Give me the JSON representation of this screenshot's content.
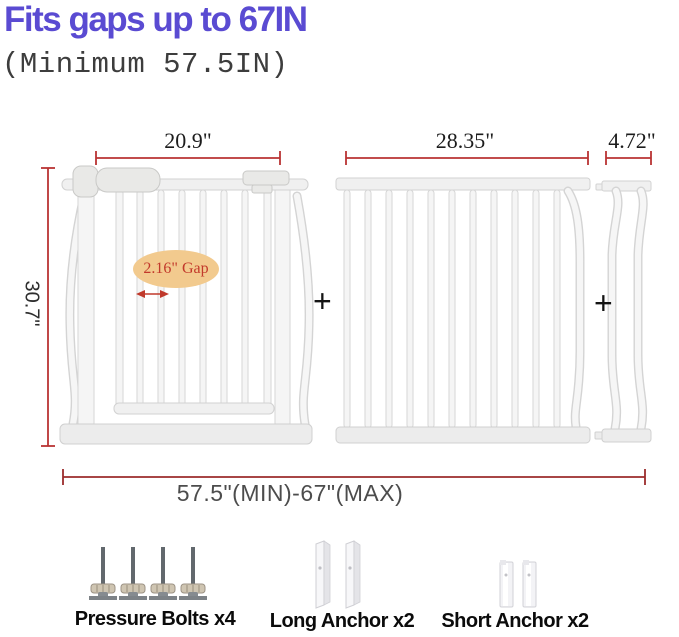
{
  "header": {
    "title": "Fits gaps up to 67IN",
    "subtitle": "(Minimum 57.5IN)"
  },
  "diagram": {
    "gate_width_label": "20.9\"",
    "extension_width_label": "28.35\"",
    "small_extension_width_label": "4.72\"",
    "height_label": "30.7\"",
    "range_label": "57.5\"(MIN)-67\"(MAX)",
    "gap_label": "2.16\" Gap",
    "plus_sign": "+"
  },
  "accessories": {
    "pressure_bolts_label": "Pressure Bolts x4",
    "long_anchor_label": "Long Anchor x2",
    "short_anchor_label": "Short Anchor x2"
  },
  "icons": {
    "pressure_bolt": "pressure-bolt-icon",
    "long_anchor": "long-anchor-icon",
    "short_anchor": "short-anchor-icon",
    "gap_arrow": "gap-arrow-icon",
    "plus": "plus-sign"
  },
  "colors": {
    "title_purple": "#5a4bd2",
    "dimension_red": "#b93333",
    "bottom_dimension_red": "#9b2c2c",
    "gap_ellipse_fill": "#f2ca8e",
    "gap_text_red": "#c2392b",
    "gate_white": "#f5f5f5",
    "gate_edge_gray": "#d6d6d6"
  }
}
